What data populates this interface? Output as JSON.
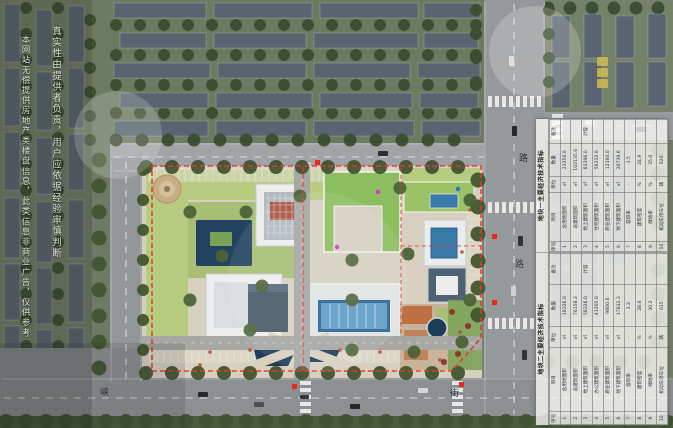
{
  "watermark": {
    "column_right": "真实性由提供者负责，用户应依据经验审慎判断",
    "column_left": "本网站无偿提供房地产类楼盘信息，此类信息非商业广告，仅供参考"
  },
  "road_labels": [
    {
      "text": "峡"
    },
    {
      "text": "街"
    },
    {
      "text": "路"
    },
    {
      "text": "路"
    }
  ],
  "indicator_tables": [
    {
      "title": "地块一主要经济技术指标",
      "headers": [
        "序号",
        "项目",
        "单位",
        "数量",
        "备注"
      ],
      "rows": [
        [
          "1",
          "总用地面积",
          "㎡",
          "23256.0",
          ""
        ],
        [
          "2",
          "总建筑面积",
          "㎡",
          "102135.6",
          ""
        ],
        [
          "3",
          "地上建筑面积",
          "㎡",
          "81396.0",
          "计容"
        ],
        [
          "4",
          "住宅建筑面积",
          "㎡",
          "56232.0",
          ""
        ],
        [
          "5",
          "商业建筑面积",
          "㎡",
          "12160.0",
          ""
        ],
        [
          "6",
          "地下建筑面积",
          "㎡",
          "20739.6",
          ""
        ],
        [
          "7",
          "容积率",
          "-",
          "3.5",
          ""
        ],
        [
          "8",
          "建筑密度",
          "%",
          "24.9",
          ""
        ],
        [
          "9",
          "绿地率",
          "%",
          "35.0",
          ""
        ],
        [
          "10",
          "机动车停车位",
          "辆",
          "826",
          ""
        ]
      ]
    },
    {
      "title": "地块二主要经济技术指标",
      "headers": [
        "序号",
        "项目",
        "单位",
        "数量",
        "备注"
      ],
      "rows": [
        [
          "1",
          "总用地面积",
          "㎡",
          "18326.0",
          ""
        ],
        [
          "2",
          "总建筑面积",
          "㎡",
          "76158.3",
          ""
        ],
        [
          "3",
          "地上建筑面积",
          "㎡",
          "58326.0",
          "计容"
        ],
        [
          "4",
          "办公建筑面积",
          "㎡",
          "41205.0",
          ""
        ],
        [
          "5",
          "商业建筑面积",
          "㎡",
          "9800.0",
          ""
        ],
        [
          "6",
          "地下建筑面积",
          "㎡",
          "17832.3",
          ""
        ],
        [
          "7",
          "容积率",
          "-",
          "3.2",
          ""
        ],
        [
          "8",
          "建筑密度",
          "%",
          "28.6",
          ""
        ],
        [
          "9",
          "绿地率",
          "%",
          "30.2",
          ""
        ],
        [
          "10",
          "机动车停车位",
          "辆",
          "615",
          ""
        ]
      ]
    }
  ],
  "colors": {
    "boundary_red": "#e8392b",
    "pool_blue": "#3a7aa9",
    "lawn_green": "#b7cc80",
    "green_roof": "#8cbd5f",
    "road_gray": "#96999c"
  }
}
